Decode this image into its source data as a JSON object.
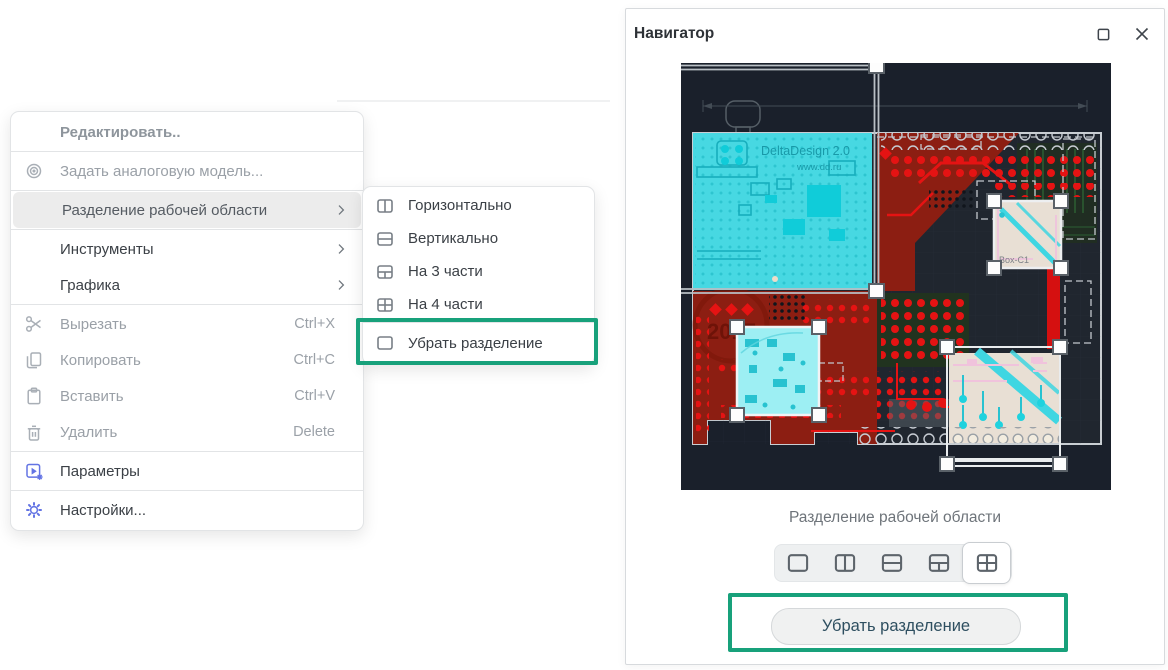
{
  "context_menu": {
    "header_label": "Редактировать..",
    "analog_model_label": "Задать аналоговую модель...",
    "split_label": "Разделение рабочей области",
    "tools_label": "Инструменты",
    "graphics_label": "Графика",
    "cut_label": "Вырезать",
    "cut_shortcut": "Ctrl+X",
    "copy_label": "Копировать",
    "copy_shortcut": "Ctrl+C",
    "paste_label": "Вставить",
    "paste_shortcut": "Ctrl+V",
    "delete_label": "Удалить",
    "delete_shortcut": "Delete",
    "parameters_label": "Параметры",
    "settings_label": "Настройки..."
  },
  "submenu": {
    "horizontal_label": "Горизонтально",
    "vertical_label": "Вертикально",
    "three_parts_label": "На 3 части",
    "four_parts_label": "На 4 части",
    "remove_split_label": "Убрать разделение"
  },
  "navigator": {
    "title": "Навигатор",
    "split_section_label": "Разделение рабочей области",
    "remove_split_button_label": "Убрать разделение"
  },
  "pcb": {
    "brand_text": "DeltaDesign 2.0",
    "site_text": "www.dd.ru",
    "year_text": "2017",
    "component_label": "Box-C1"
  },
  "colors": {
    "highlight_green": "#18a17b",
    "accent_blue": "#6374e4",
    "pcb_background": "#1a202b",
    "pcb_copper_red": "#e51313",
    "pcb_selection_cyan": "#47d8e2"
  }
}
